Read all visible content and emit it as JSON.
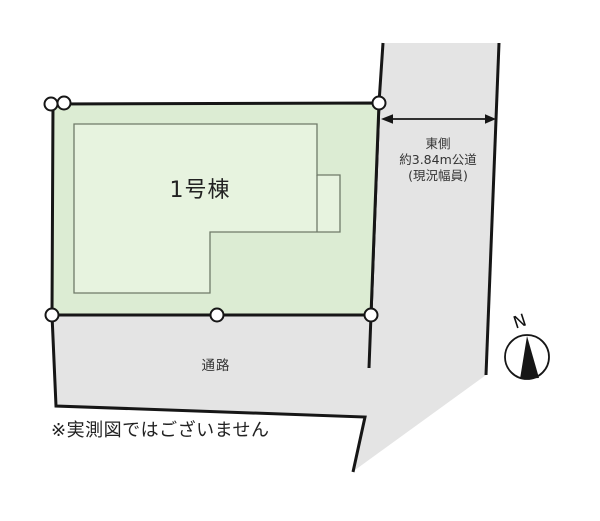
{
  "site_plan": {
    "building_label": "1号棟",
    "road_label": {
      "line1": "東側",
      "line2": "約3.84m公道",
      "line3": "(現況幅員)"
    },
    "passage_label": "通路",
    "note": "※実測図ではございません",
    "compass_label": "N"
  },
  "colors": {
    "background": "#ffffff",
    "plot_fill": "#dcecd3",
    "building_fill": "#e7f3df",
    "building_stroke": "#6f7a68",
    "road_fill": "#e4e4e4",
    "line": "#161616",
    "text": "#222222"
  }
}
